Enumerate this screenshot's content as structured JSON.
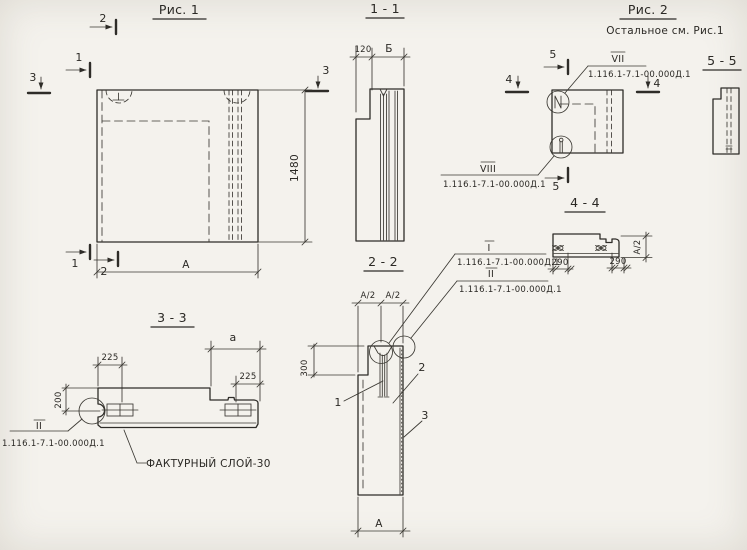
{
  "colors": {
    "paper": "#f4f2ed",
    "ink": "#2e2c28"
  },
  "fig1": {
    "title": "Рис. 1",
    "marks": {
      "top2": "2",
      "top1": "1",
      "left3": "3",
      "right3": "3",
      "bottom1": "1",
      "bottom2": "2"
    },
    "dims": {
      "height": "1480",
      "width": "А"
    }
  },
  "s11": {
    "title": "1 - 1",
    "dims": {
      "d120": "120",
      "dB": "Б"
    }
  },
  "s22": {
    "title": "2 - 2",
    "dims": {
      "a2l": "А/2",
      "a2r": "А/2",
      "d300": "300",
      "width": "А"
    },
    "callouts": {
      "c1": "1",
      "c2": "2",
      "c3": "3"
    }
  },
  "fig2": {
    "title": "Рис. 2",
    "note": "Остальное см. Рис.1",
    "marks": {
      "top5": "5",
      "left4": "4",
      "right4": "4",
      "bottom5": "5"
    },
    "label_vii": {
      "num": "VII",
      "code": "1.116.1-7.1-00.000Д.1"
    },
    "label_viii": {
      "num": "VIII",
      "code": "1.116.1-7.1-00.000Д.1"
    }
  },
  "s55": {
    "title": "5 - 5"
  },
  "s44": {
    "title": "4 - 4",
    "label_i": {
      "num": "I",
      "code": "1.116.1-7.1-00.000Д.1"
    },
    "label_ii": {
      "num": "II",
      "code": "1.116.1-7.1-00.000Д.1"
    },
    "dims": {
      "d290l": "290",
      "d290r": "290",
      "a2": "А/2"
    }
  },
  "s33": {
    "title": "3 - 3",
    "dims": {
      "d225l": "225",
      "da": "а",
      "d225r": "225",
      "d200": "200"
    },
    "label_ii": {
      "num": "II",
      "code": "1.116.1-7.1-00.000Д.1"
    },
    "note": "ФАКТУРНЫЙ СЛОЙ-30"
  }
}
